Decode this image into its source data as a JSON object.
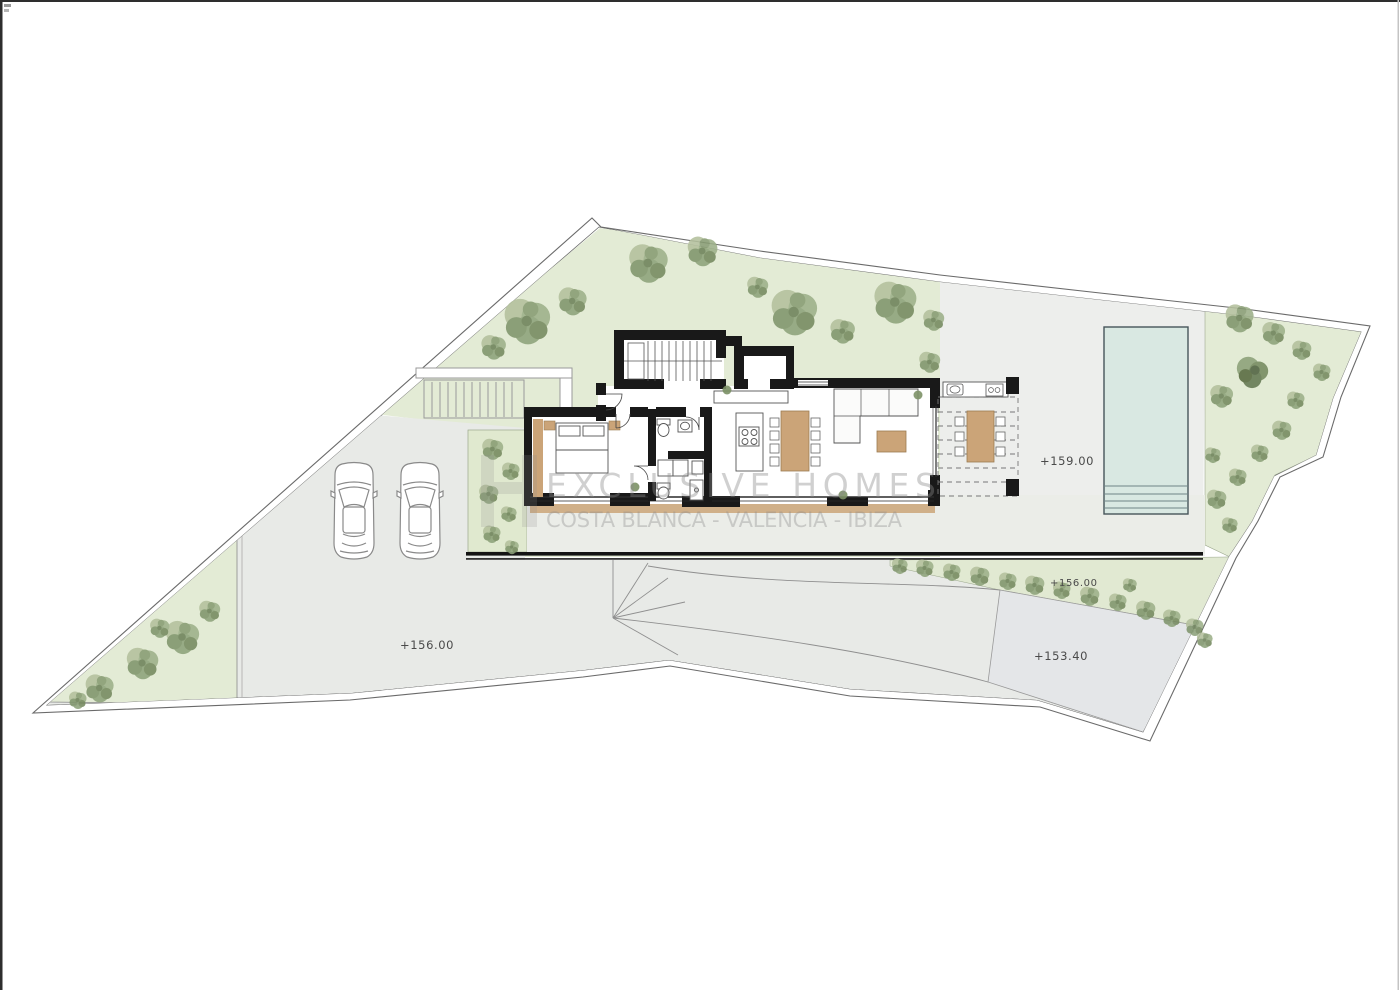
{
  "watermark": {
    "brand": "EXCLUSIVE HOMES",
    "regions": "COSTA BLANCA - VALENCIA - IBIZA"
  },
  "labels": {
    "pool_terrace_level": "+159.00",
    "driveway_level": "+156.00",
    "garden_band_level": "+156.00",
    "lower_terrace_level": "+153.40"
  },
  "palette": {
    "garden_green": "#e3ebd5",
    "tree_green": "#8ea37a",
    "paving_grey": "#e8eae7",
    "pool_terrace_grey": "#edeeec",
    "pool_water": "#d9e8e2",
    "wall_black": "#191919",
    "wood_tan": "#cba478",
    "boundary_line": "#6a6a6a",
    "watermark_grey": "#8a8a8a"
  }
}
